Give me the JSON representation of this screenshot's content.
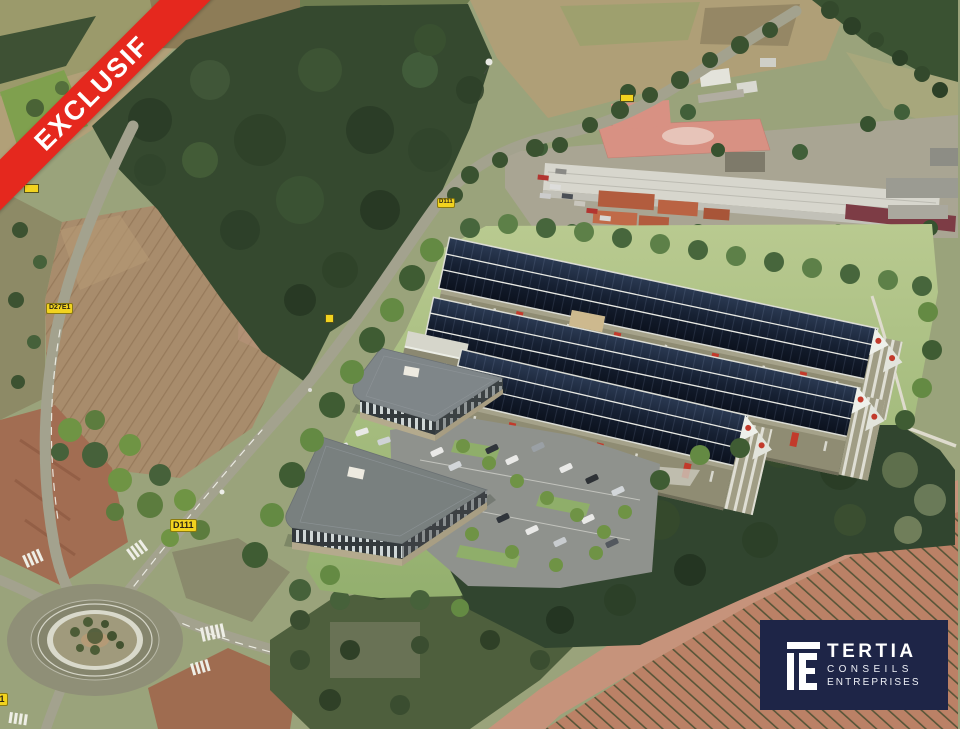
{
  "ribbon": {
    "label": "EXCLUSIF",
    "color": "#e5281e",
    "text_color": "#ffffff"
  },
  "road_labels": {
    "d111_upper": "D111",
    "d111_lower": "D111",
    "d27e1": "D27E1",
    "d27e1_partial": "D27E1",
    "background": "#f2d31f",
    "text_color": "#2a2415"
  },
  "logo": {
    "brand": "TERTIA",
    "line2": "CONSEILS",
    "line3": "ENTREPRISES",
    "background": "#1e2547",
    "mark_icon": "tertia-monogram-icon"
  }
}
